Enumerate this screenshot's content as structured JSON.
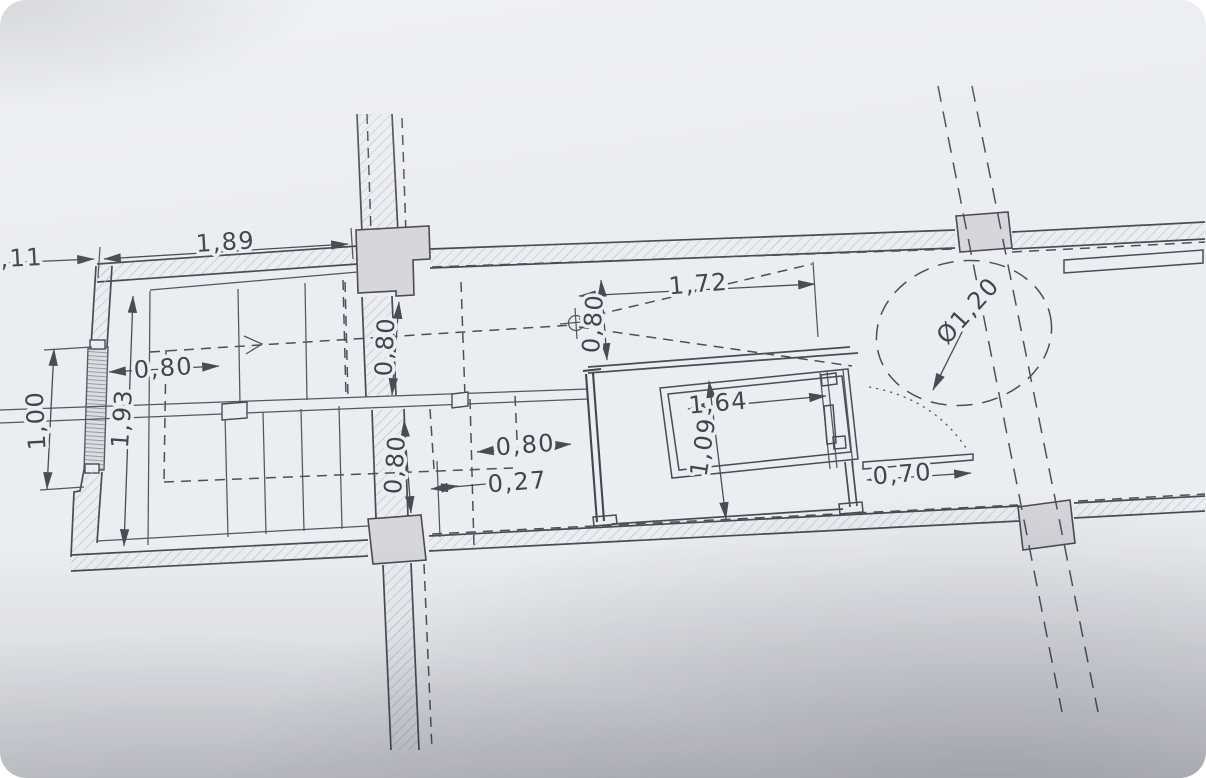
{
  "meta": {
    "title": "Photographed architectural floor plan detail — staircase and elevator core with dimension annotations",
    "drawing_type": "floor-plan",
    "units_style": "comma decimal meters"
  },
  "colors": {
    "paper": "#ecedf0",
    "line": "#4b4b52",
    "column_fill": "#d6d6db",
    "hatch": "#b9b9c2",
    "shadow": "#b5b5bc"
  },
  "labels": [
    {
      "id": "partial-left-width",
      "text": ",11"
    },
    {
      "id": "top-width",
      "text": "1,89"
    },
    {
      "id": "room-opening-width",
      "text": "0,80"
    },
    {
      "id": "window-width",
      "text": "1,00"
    },
    {
      "id": "stair-room-depth",
      "text": "1,93"
    },
    {
      "id": "upper-flight-width",
      "text": "0,80"
    },
    {
      "id": "lower-flight-width",
      "text": "0,80"
    },
    {
      "id": "corridor-opening",
      "text": "0,80"
    },
    {
      "id": "wall-offset",
      "text": "0,27"
    },
    {
      "id": "landing-clearance",
      "text": "0,80"
    },
    {
      "id": "landing-length",
      "text": "1,72"
    },
    {
      "id": "turning-circle",
      "text": "Ø1,20"
    },
    {
      "id": "shaft-width",
      "text": "1,64"
    },
    {
      "id": "shaft-depth",
      "text": "1,09"
    },
    {
      "id": "door-width",
      "text": "0,70"
    }
  ],
  "symbols": [
    {
      "name": "datum-point-icon",
      "meaning": "axis datum / survey point"
    },
    {
      "name": "stair-direction-arrow-icon",
      "meaning": "walking line direction"
    },
    {
      "name": "turning-circle",
      "meaning": "dashed clearance circle Ø1,20"
    },
    {
      "name": "window-symbol",
      "meaning": "window in left exterior wall"
    }
  ]
}
